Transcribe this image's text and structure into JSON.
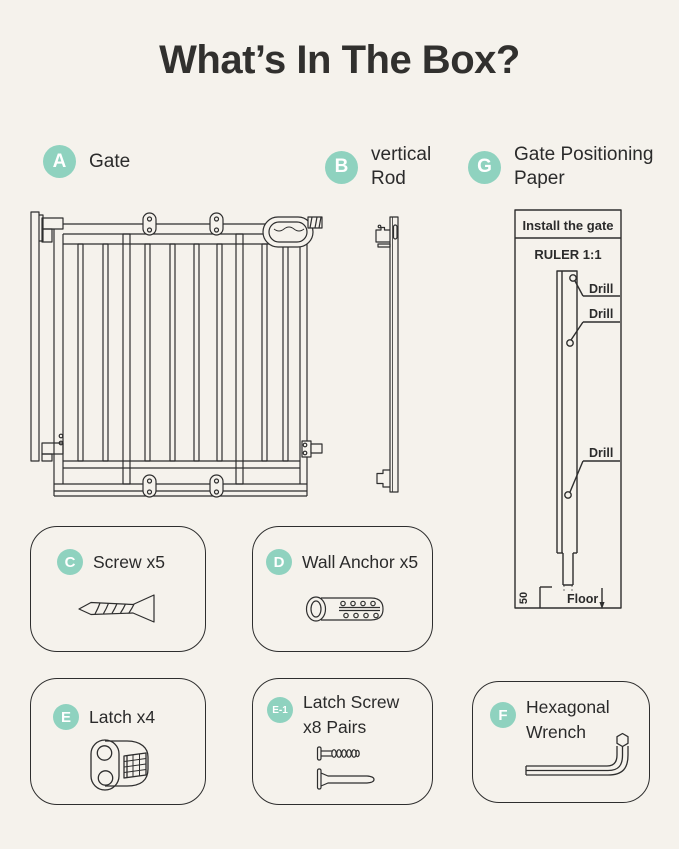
{
  "title": "What’s In The Box?",
  "colors": {
    "background": "#F5F2EC",
    "ink": "#2B2B2B",
    "accent": "#8FD2BF",
    "line": "#2E2E2E"
  },
  "legend": {
    "gate": {
      "badge": "A",
      "label": "Gate"
    },
    "rod": {
      "badge": "B",
      "lines": [
        "vertical",
        "Rod"
      ]
    },
    "paper": {
      "badge": "G",
      "lines": [
        "Gate Positioning",
        "Paper"
      ]
    }
  },
  "sheet": {
    "header": "Install the gate",
    "ruler": "RULER 1:1",
    "drill": "Drill",
    "floor": "Floor",
    "offset": "50"
  },
  "kit": {
    "screw": {
      "badge": "C",
      "label": "Screw x5"
    },
    "anchor": {
      "badge": "D",
      "label": "Wall Anchor x5"
    },
    "latch": {
      "badge": "E",
      "label": "Latch x4"
    },
    "latch_screw": {
      "badge": "E-1",
      "lines": [
        "Latch Screw",
        "x8 Pairs"
      ]
    },
    "wrench": {
      "badge": "F",
      "lines": [
        "Hexagonal",
        "Wrench"
      ]
    }
  }
}
